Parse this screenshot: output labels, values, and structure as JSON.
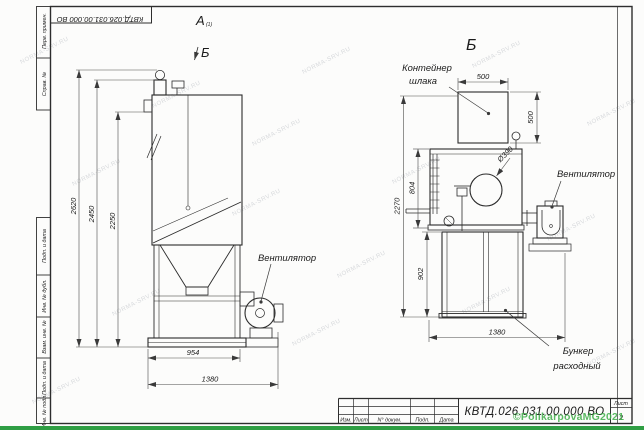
{
  "frame": {
    "top_stamp": "КВТД.026.031.00.000  ВО",
    "left_top_cells": [
      "Перв. примен.",
      "Справ. №"
    ],
    "left_bottom_cells": [
      "Подп. и дата",
      "Инв. № дубл.",
      "Взам. инв. №",
      "Подп. и дата",
      "Инв. № подл."
    ]
  },
  "title_block": {
    "doc_number": "КВТД.026.031.00.000  ВО",
    "columns": [
      "Изм.",
      "Лист",
      "N° докум.",
      "Подп.",
      "Дата"
    ],
    "sheet_label": "Лист",
    "sheet_number": "2"
  },
  "front_view": {
    "detail_label": "А",
    "detail_label_sub": "(1)",
    "view_arrow_label": "Б",
    "fan_label": "Вентилятор",
    "dim_height_overall": "2620",
    "dim_height_duct": "2450",
    "dim_height_body": "2250",
    "dim_width_base": "954",
    "dim_width_overall": "1380"
  },
  "side_view": {
    "view_title": "Б",
    "container_label_1": "Контейнер",
    "container_label_2": "шлака",
    "fan_label": "Вентилятор",
    "hopper_label_1": "Бункер",
    "hopper_label_2": "расходный",
    "dim_container_width": "500",
    "dim_container_height": "500",
    "dim_port_diameter": "Ø390",
    "dim_body_height": "804",
    "dim_total_height": "2270",
    "dim_cabinet_height": "902",
    "dim_depth_overall": "1380"
  },
  "watermark": {
    "tile_text": "NORMA-SRV.RU",
    "author": "©PolikarpovaMG2021",
    "colors": {
      "author_green": "#3fae49",
      "bottom_strip": "#2f9e44"
    }
  }
}
